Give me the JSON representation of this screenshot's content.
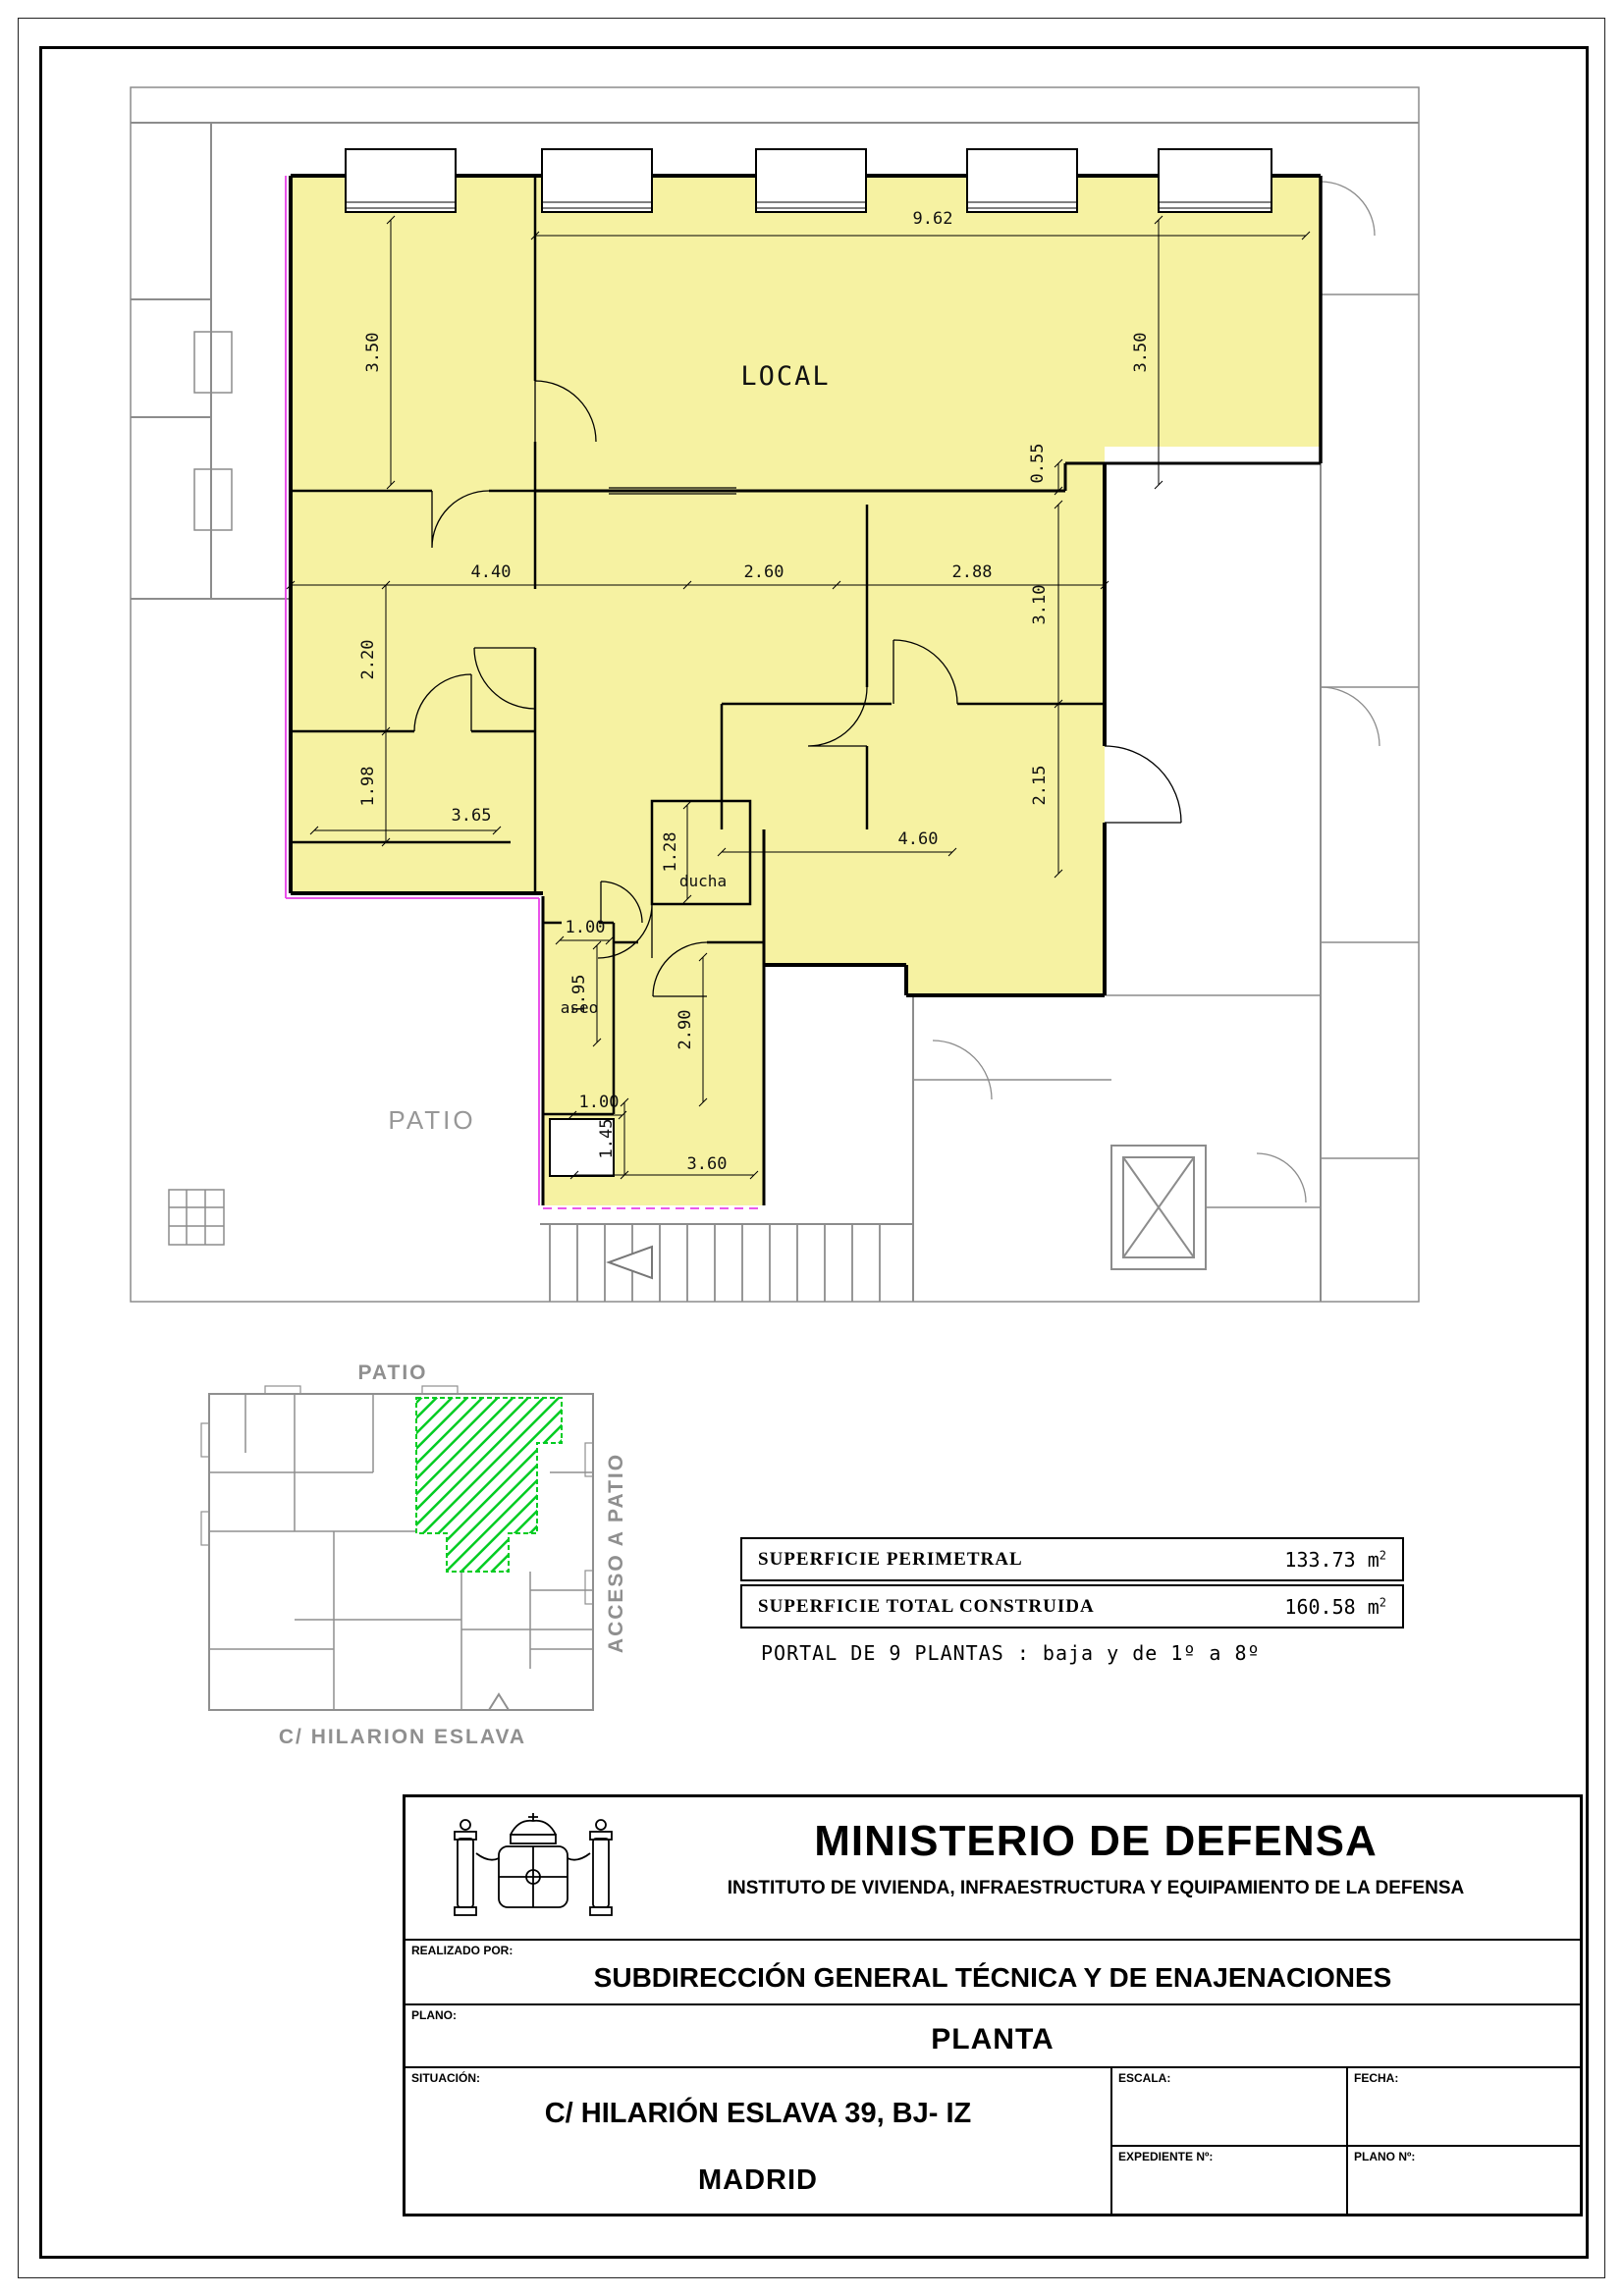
{
  "colors": {
    "unit_fill": "#f6f2a2",
    "boundary_magenta": "#e840e8",
    "context_gray": "#8c8c8c",
    "highlight_green": "#00cc22"
  },
  "plan": {
    "room_labels": {
      "local": "LOCAL",
      "ducha": "ducha",
      "aseo": "aseo",
      "patio": "PATIO"
    },
    "dims": {
      "d962": "9.62",
      "d350l": "3.50",
      "d350r": "3.50",
      "d055": "0.55",
      "d440": "4.40",
      "d260": "2.60",
      "d288": "2.88",
      "d220": "2.20",
      "d198": "1.98",
      "d365": "3.65",
      "d310": "3.10",
      "d215": "2.15",
      "d460": "4.60",
      "d128": "1.28",
      "d100a": "1.00",
      "d195": "1.95",
      "d290": "2.90",
      "d100b": "1.00",
      "d145": "1.45",
      "d360": "3.60"
    }
  },
  "siteplan": {
    "patio_label": "PATIO",
    "acceso_label": "ACCESO A PATIO",
    "street_label": "C/ HILARION ESLAVA"
  },
  "summary": {
    "rows": [
      {
        "label": "SUPERFICIE PERIMETRAL",
        "value": "133.73",
        "unit": "m",
        "unit_exp": "2"
      },
      {
        "label": "SUPERFICIE TOTAL CONSTRUIDA",
        "value": "160.58",
        "unit": "m",
        "unit_exp": "2"
      }
    ],
    "portal_note": "PORTAL DE 9 PLANTAS : baja y de 1º a 8º"
  },
  "titleblock": {
    "ministry": "MINISTERIO DE DEFENSA",
    "institute": "INSTITUTO DE VIVIENDA, INFRAESTRUCTURA Y EQUIPAMIENTO DE LA DEFENSA",
    "realizado_label": "REALIZADO POR:",
    "subdireccion": "SUBDIRECCIÓN GENERAL TÉCNICA Y DE ENAJENACIONES",
    "plano_label": "PLANO:",
    "plano": "PLANTA",
    "situacion_label": "SITUACIÓN:",
    "situacion_line1": "C/ HILARIÓN ESLAVA 39, BJ- IZ",
    "situacion_line2": "MADRID",
    "escala_label": "ESCALA:",
    "fecha_label": "FECHA:",
    "expediente_label": "EXPEDIENTE Nº:",
    "plano_n_label": "PLANO Nº:"
  }
}
